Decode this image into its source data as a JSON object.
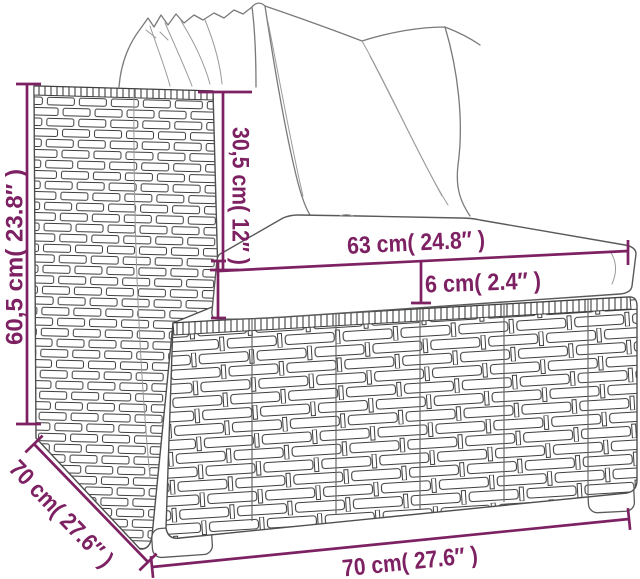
{
  "page": {
    "title": "Rattan sofa section dimension diagram",
    "background": "#ffffff"
  },
  "diagram": {
    "product": "poly rattan garden sofa section with white cushions",
    "style": "black-and-white line drawing with purple dimension annotations",
    "accent_color": "#7d2162",
    "line_color": "#5a5a5a",
    "dimensions": {
      "total_height": {
        "label": "60,5 cm( 23.8″ )",
        "value_cm": "60,5",
        "value_in": "23.8",
        "orientation": "vertical-left"
      },
      "backrest_height": {
        "label": "30,5 cm( 12″ )",
        "value_cm": "30,5",
        "value_in": "12",
        "orientation": "vertical-inner"
      },
      "seat_width": {
        "label": "63 cm( 24.8″ )",
        "value_cm": "63",
        "value_in": "24.8",
        "orientation": "horizontal-over-seat"
      },
      "cushion_thickness": {
        "label": "6 cm( 2.4″ )",
        "value_cm": "6",
        "value_in": "2.4",
        "orientation": "below-seat-line"
      },
      "depth": {
        "label": "70 cm( 27.6″ )",
        "value_cm": "70",
        "value_in": "27.6",
        "orientation": "diagonal-bottom-left"
      },
      "width": {
        "label": "70 cm( 27.6″ )",
        "value_cm": "70",
        "value_in": "27.6",
        "orientation": "horizontal-bottom"
      }
    }
  }
}
